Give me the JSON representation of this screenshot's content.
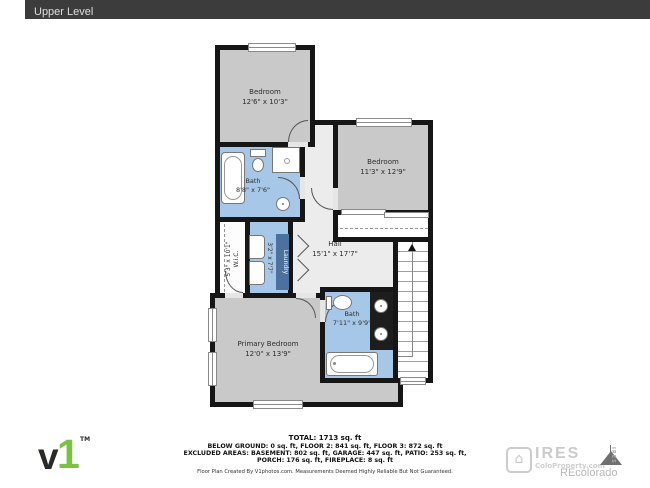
{
  "header": {
    "title": "Upper Level"
  },
  "plan": {
    "rooms": {
      "bedroom_top": {
        "name": "Bedroom",
        "dims": "12'6\" x 10'3\""
      },
      "bedroom_right": {
        "name": "Bedroom",
        "dims": "11'3\" x 12'9\""
      },
      "bath_top": {
        "name": "Bath",
        "dims": "8'8\" x 7'6\""
      },
      "wic": {
        "name": "W.i.C.",
        "dims": "5'3\" x 10'1\""
      },
      "laundry": {
        "name": "Laundry",
        "dims": "3'2\" x 7'7\""
      },
      "hall": {
        "name": "Hall",
        "dims": "15'1\" x 17'7\""
      },
      "bath_bottom": {
        "name": "Bath",
        "dims": "7'11\" x 9'9\""
      },
      "primary": {
        "name": "Primary Bedroom",
        "dims": "12'0\" x 13'9\""
      }
    },
    "colors": {
      "wall": "#161616",
      "room_gray": "#c9c9c9",
      "hall_gray": "#ececec",
      "bath_blue": "#a7c7e8",
      "laundry_chip": "#4d719f",
      "logo_green": "#7cc242"
    }
  },
  "footer": {
    "total": "TOTAL: 1713 sq. ft",
    "line1": "BELOW GROUND: 0 sq. ft, FLOOR 2: 841 sq. ft, FLOOR 3: 872 sq. ft",
    "line2": "EXCLUDED AREAS: BASEMENT: 802 sq. ft, GARAGE: 447 sq. ft, PATIO: 253 sq. ft,",
    "line3": "PORCH: 176 sq. ft, FIREPLACE: 8 sq. ft",
    "disclaimer": "Floor Plan Created By V1photos.com. Measurements Deemed Highly Reliable But Not Guaranteed."
  },
  "logos": {
    "v1": {
      "v": "v",
      "one": "1",
      "tm": "TM"
    },
    "ires": {
      "house": "⌂",
      "brand": "IRES",
      "site": "ColoProperty.com",
      "vertical": "IRES",
      "recolorado": "REcolorado"
    }
  }
}
